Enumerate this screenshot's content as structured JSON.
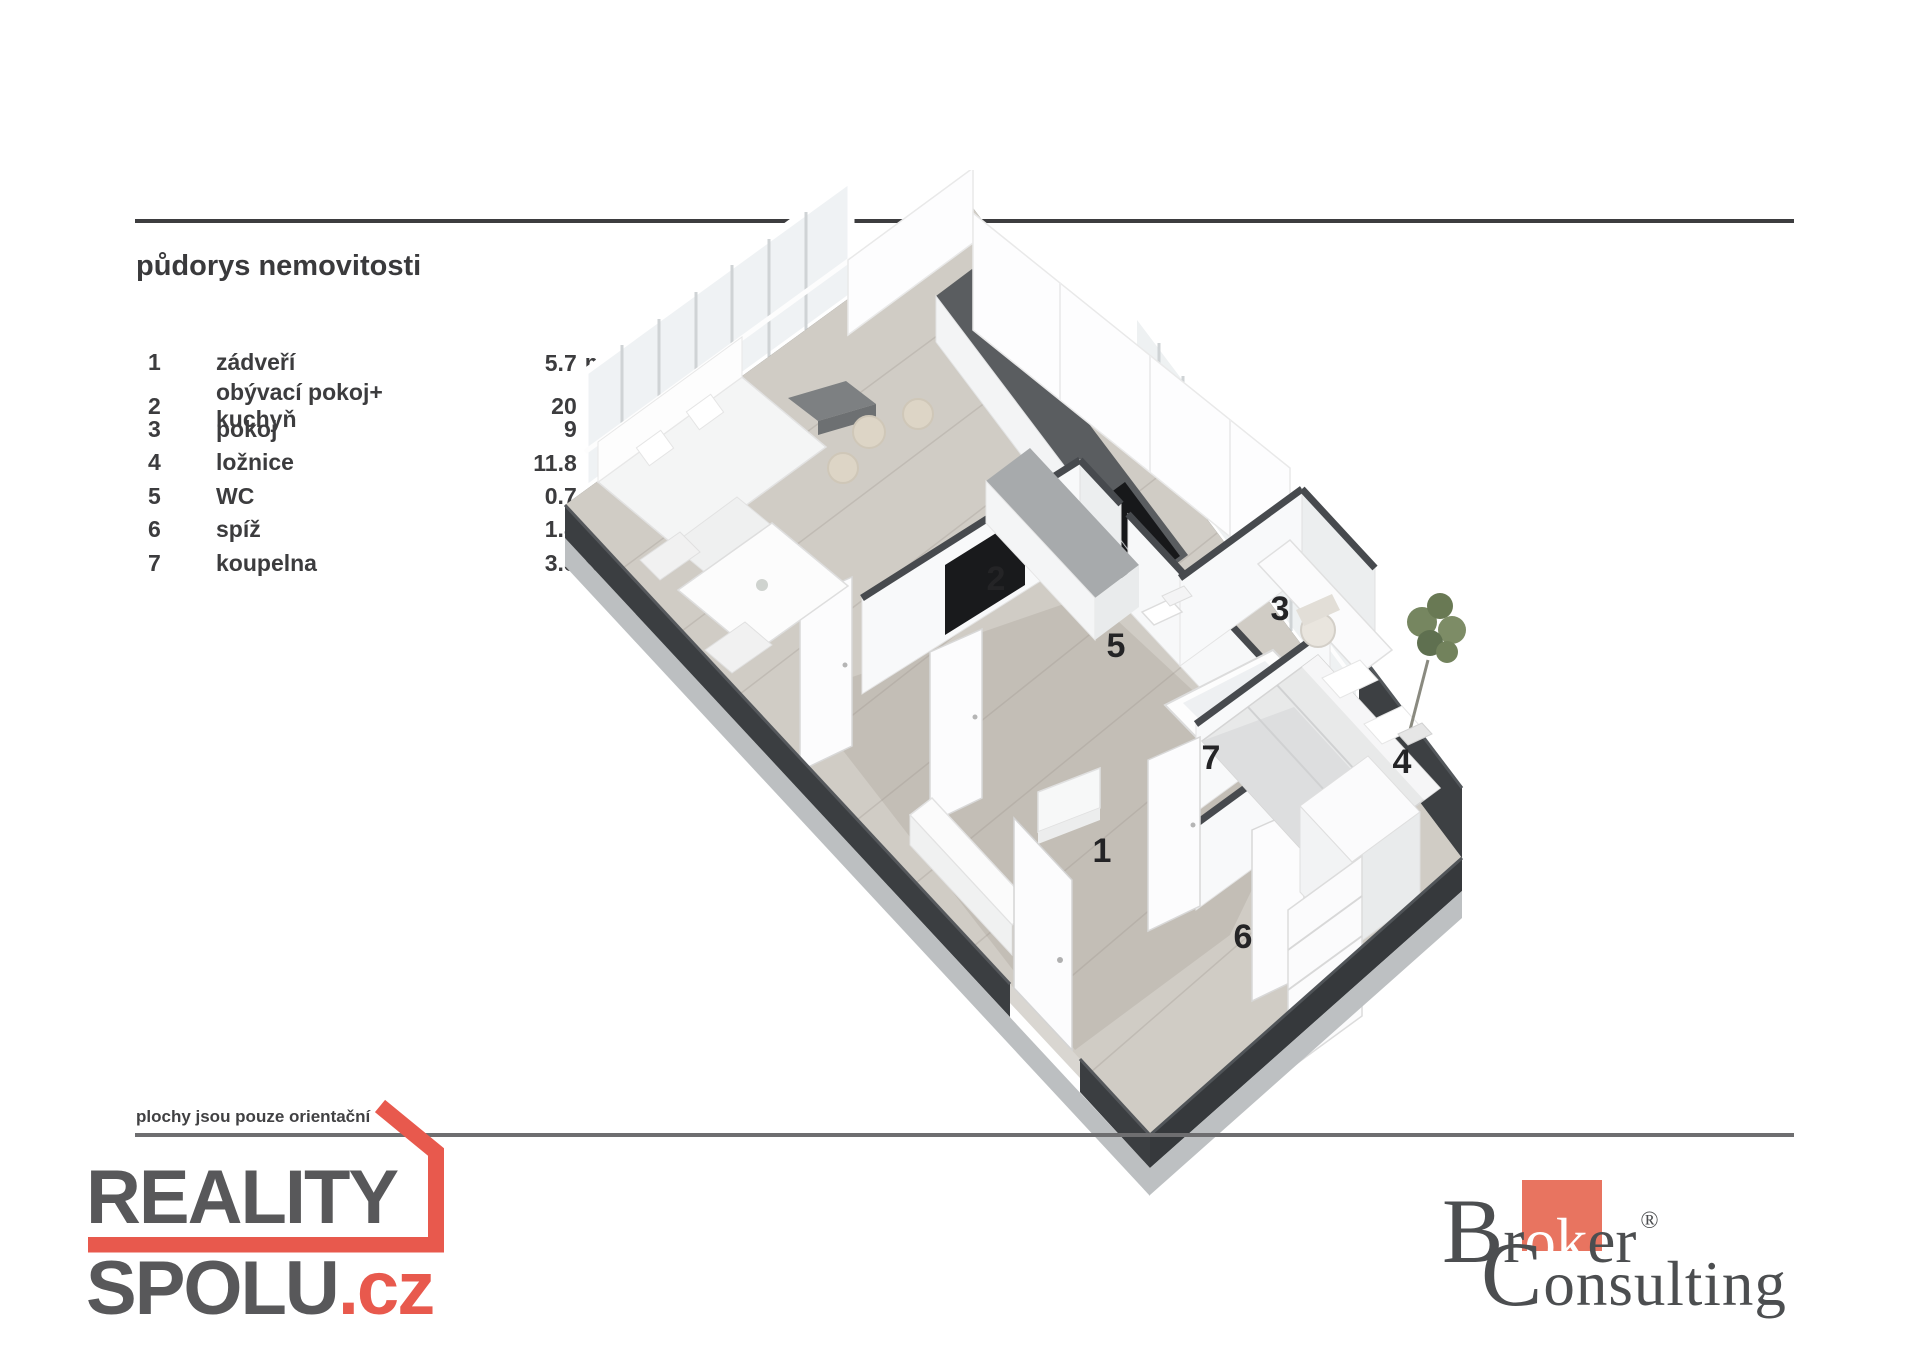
{
  "title": "půdorys nemovitosti",
  "rooms": [
    {
      "num": "1",
      "name": "zádveří",
      "area": "5.7"
    },
    {
      "num": "2",
      "name": "obývací pokoj+ kuchyň",
      "area": "20"
    },
    {
      "num": "3",
      "name": "pokoj",
      "area": "9"
    },
    {
      "num": "4",
      "name": "ložnice",
      "area": "11.8"
    },
    {
      "num": "5",
      "name": "WC",
      "area": "0.7"
    },
    {
      "num": "6",
      "name": "spíž",
      "area": "1.8"
    },
    {
      "num": "7",
      "name": "koupelna",
      "area": "3.5"
    }
  ],
  "unit": {
    "base": "m",
    "sup": "2"
  },
  "plan_labels": [
    "1",
    "2",
    "3",
    "4",
    "5",
    "6",
    "7"
  ],
  "disclaimer": "plochy jsou pouze orientační",
  "reality": {
    "word1": "REALITY",
    "word2": "SPOLU",
    "tld": ".cz",
    "red": "#e8594d",
    "gray": "#58585a"
  },
  "broker": {
    "b": "B",
    "r": "r",
    "ok": "ok",
    "er": "er",
    "reg": "®",
    "c": "C",
    "rest": "onsulting",
    "square": "#e87460",
    "text": "#4c4e50"
  }
}
